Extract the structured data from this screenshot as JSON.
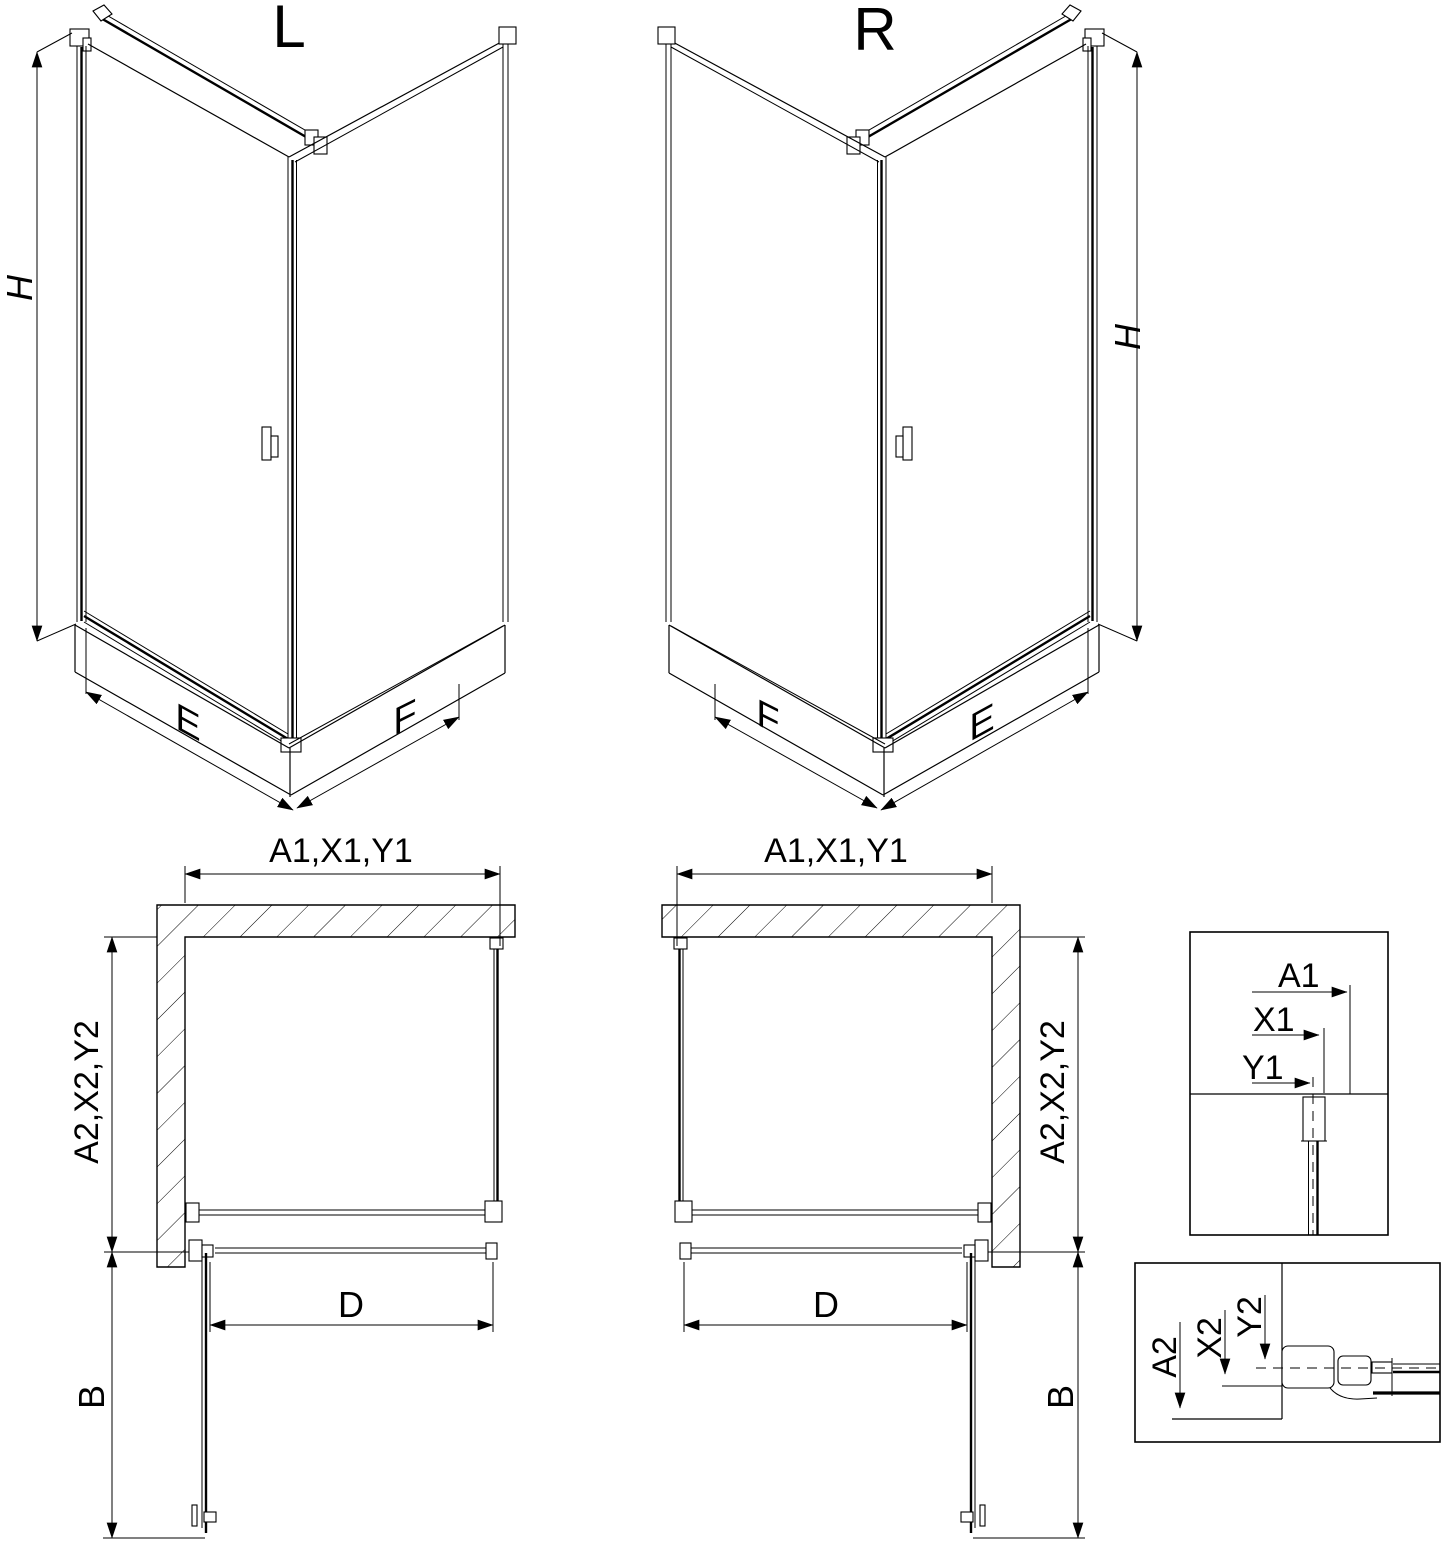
{
  "colors": {
    "line": "#000000",
    "background": "#ffffff"
  },
  "iso_left": {
    "label": "L",
    "height": "H",
    "left_face": "E",
    "right_face": "F"
  },
  "iso_right": {
    "label": "R",
    "height": "H",
    "left_face": "F",
    "right_face": "E"
  },
  "plan_left": {
    "width": "A1,X1,Y1",
    "depth": "A2,X2,Y2",
    "door_width": "D",
    "door_swing": "B"
  },
  "plan_right": {
    "width": "A1,X1,Y1",
    "depth": "A2,X2,Y2",
    "door_width": "D",
    "door_swing": "B"
  },
  "detail_top": {
    "a1": "A1",
    "x1": "X1",
    "y1": "Y1"
  },
  "detail_bottom": {
    "a2": "A2",
    "x2": "X2",
    "y2": "Y2"
  }
}
